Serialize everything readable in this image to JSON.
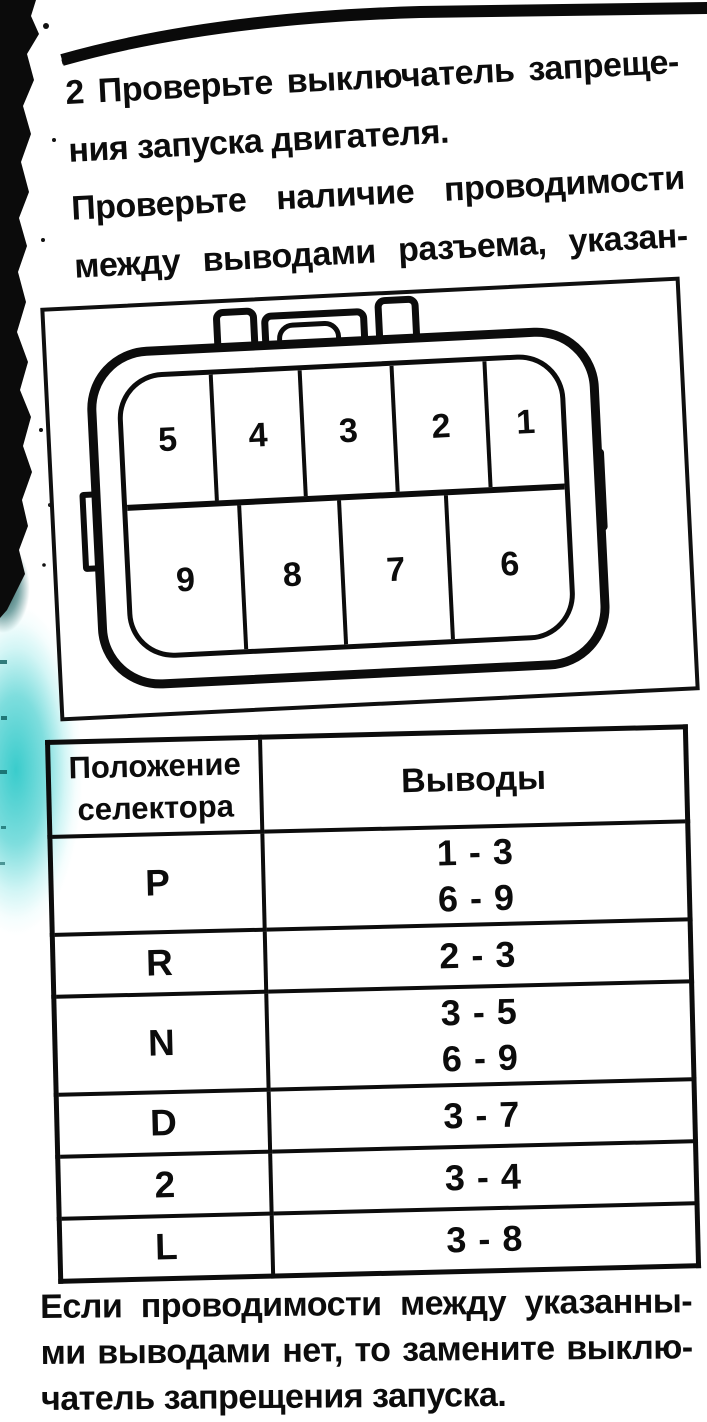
{
  "document": {
    "intro": {
      "lines": [
        "2 Проверьте выключатель запреще-",
        "ния запуска двигателя.",
        "Проверьте наличие проводимости",
        "между выводами разъема, указан-",
        "ными в таблице."
      ]
    },
    "connector_diagram": {
      "top_row_pins": [
        "5",
        "4",
        "3",
        "2",
        "1"
      ],
      "bottom_row_pins": [
        "9",
        "8",
        "7",
        "6"
      ]
    },
    "table": {
      "header": {
        "col1_line1": "Положение",
        "col1_line2": "селектора",
        "col2": "Выводы"
      },
      "rows": [
        {
          "position": "P",
          "pins": [
            "1 - 3",
            "6 - 9"
          ]
        },
        {
          "position": "R",
          "pins": [
            "2 - 3"
          ]
        },
        {
          "position": "N",
          "pins": [
            "3 - 5",
            "6 - 9"
          ]
        },
        {
          "position": "D",
          "pins": [
            "3 - 7"
          ]
        },
        {
          "position": "2",
          "pins": [
            "3 - 4"
          ]
        },
        {
          "position": "L",
          "pins": [
            "3 - 8"
          ]
        }
      ]
    },
    "outro": {
      "lines": [
        "Если проводимости между указанны-",
        "ми выводами нет, то замените выклю-",
        "чатель запрещения запуска."
      ]
    },
    "colors": {
      "ink": "#0c0c0c",
      "highlight": "#2fc9c9"
    }
  }
}
